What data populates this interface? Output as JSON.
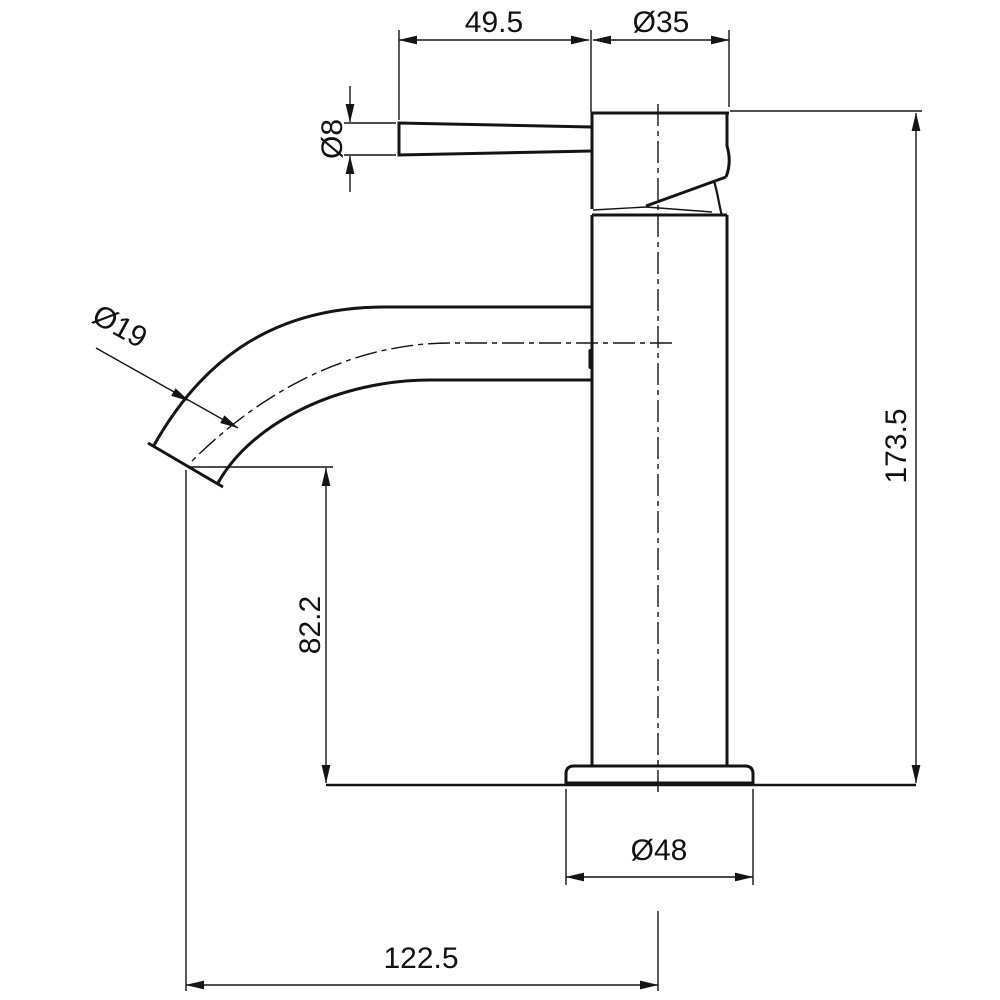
{
  "drawing": {
    "type": "technical-dimension-drawing",
    "subject": "single-lever basin mixer tap, side elevation",
    "background_color": "#ffffff",
    "line_color": "#141414",
    "dimensions": {
      "lever_length": "49.5",
      "head_diameter": "Ø35",
      "lever_rod_diameter": "Ø8",
      "spout_tube_diameter": "Ø19",
      "overall_height": "173.5",
      "spout_outlet_height": "82.2",
      "base_flange_diameter": "Ø48",
      "spout_reach": "122.5"
    }
  }
}
